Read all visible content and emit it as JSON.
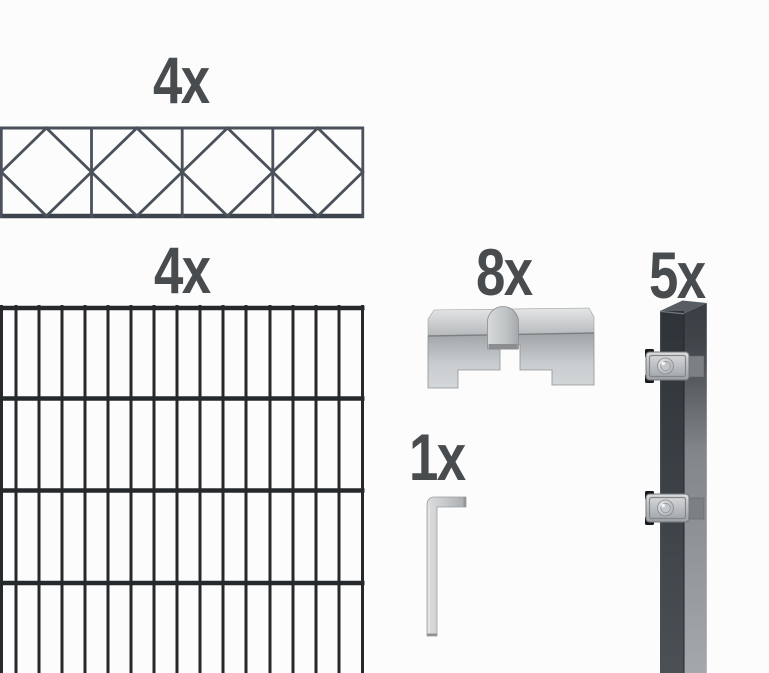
{
  "background_color": "#fcfcfc",
  "items": [
    {
      "name": "decorative-extension-panel",
      "qty": "4x"
    },
    {
      "name": "double-rod-mesh-panel",
      "qty": "4x"
    },
    {
      "name": "cover-clamp",
      "qty": "8x"
    },
    {
      "name": "allen-key",
      "qty": "1x"
    },
    {
      "name": "fence-post",
      "qty": "5x"
    }
  ],
  "colors": {
    "background": "#fcfcfc",
    "label": "#494c4e",
    "decor-wire": "#4a515b",
    "decor-rail": "#3d444d",
    "mesh-wire": "#26292c",
    "steel-light": "#d9dbdc",
    "steel-mid": "#b5b8bb",
    "steel-dark": "#8d9194",
    "cap-black": "#17191c",
    "post-front-dark": "#2e3338",
    "post-side-light": "#a4a8ac",
    "post-top-face": "#575d62"
  }
}
